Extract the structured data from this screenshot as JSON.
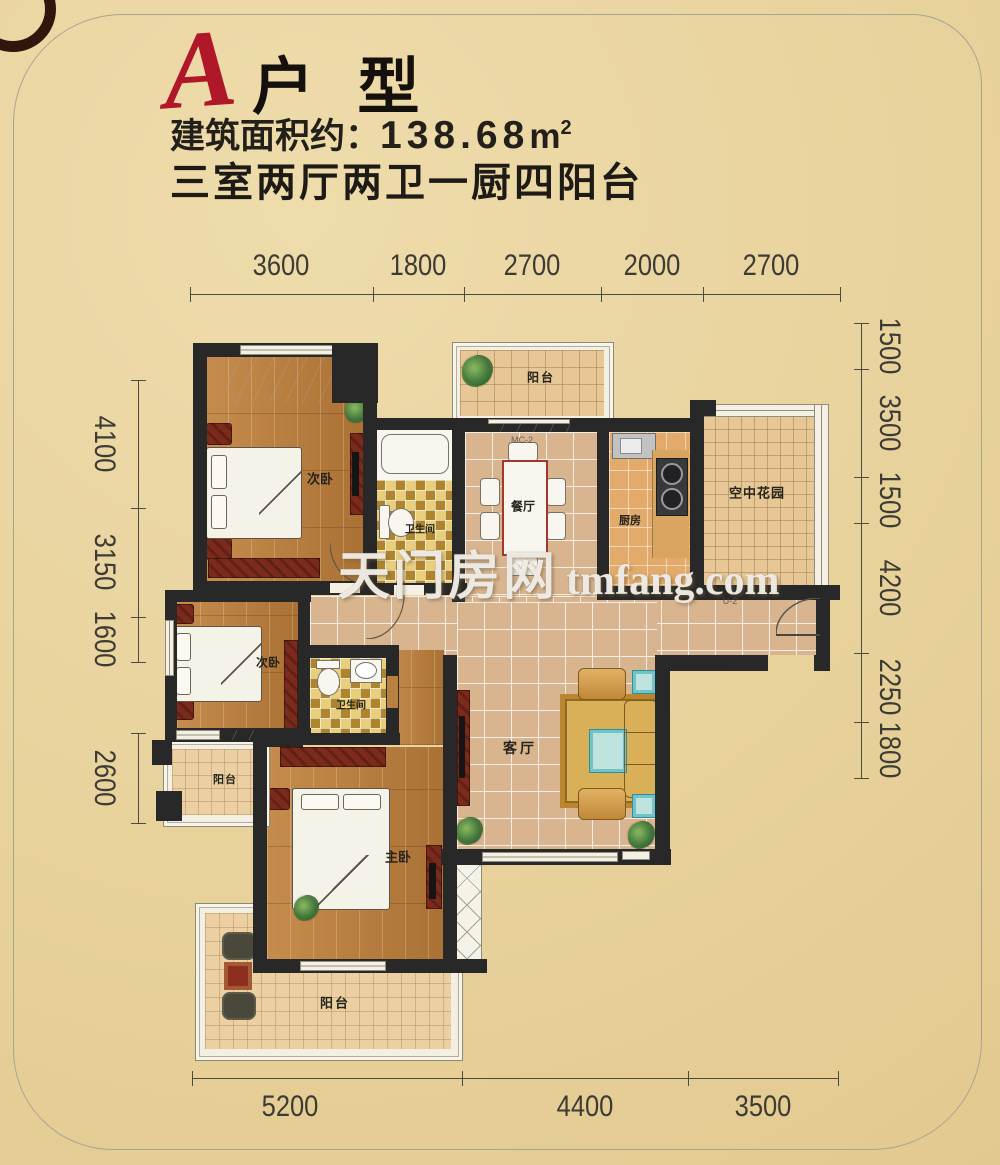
{
  "page": {
    "bg_color": "#e8d29c",
    "frame_color": "#a8a492",
    "wall_color": "#282828",
    "accent_red": "#b0182a",
    "text_dark": "#1e1a16"
  },
  "header": {
    "unit_letter": "A",
    "unit_name": "户 型",
    "area_label": "建筑面积约：",
    "area_value": "138.68",
    "area_unit": "m",
    "area_sup": "2",
    "layout_desc": "三室两厅两卫一厨四阳台"
  },
  "watermark": {
    "cn": "天门房网",
    "en": "tmfang.com"
  },
  "rooms": {
    "bedroom_top": {
      "label": "次卧"
    },
    "bathroom_top": {
      "label": "卫生间"
    },
    "balcony_top": {
      "label": "阳台"
    },
    "dining": {
      "label": "餐厅"
    },
    "kitchen": {
      "label": "厨房"
    },
    "sky_garden": {
      "label": "空中花园"
    },
    "bedroom_mid": {
      "label": "次卧"
    },
    "bathroom_mid": {
      "label": "卫生间"
    },
    "balcony_left": {
      "label": "阳台"
    },
    "living": {
      "label": "客厅"
    },
    "master_bedroom": {
      "label": "主卧"
    },
    "balcony_bottom": {
      "label": "阳台"
    }
  },
  "door_codes": {
    "dining_window": "MC-2",
    "entry_door": "U-2"
  },
  "dimensions": {
    "top": [
      "3600",
      "1800",
      "2700",
      "2000",
      "2700"
    ],
    "bottom": [
      "5200",
      "4400",
      "3500"
    ],
    "left_upper": [
      "4100",
      "3150",
      "1600"
    ],
    "left_lower": [
      "2600"
    ],
    "right": [
      "1500",
      "3500",
      "1500",
      "4200",
      "2250",
      "1800"
    ]
  }
}
